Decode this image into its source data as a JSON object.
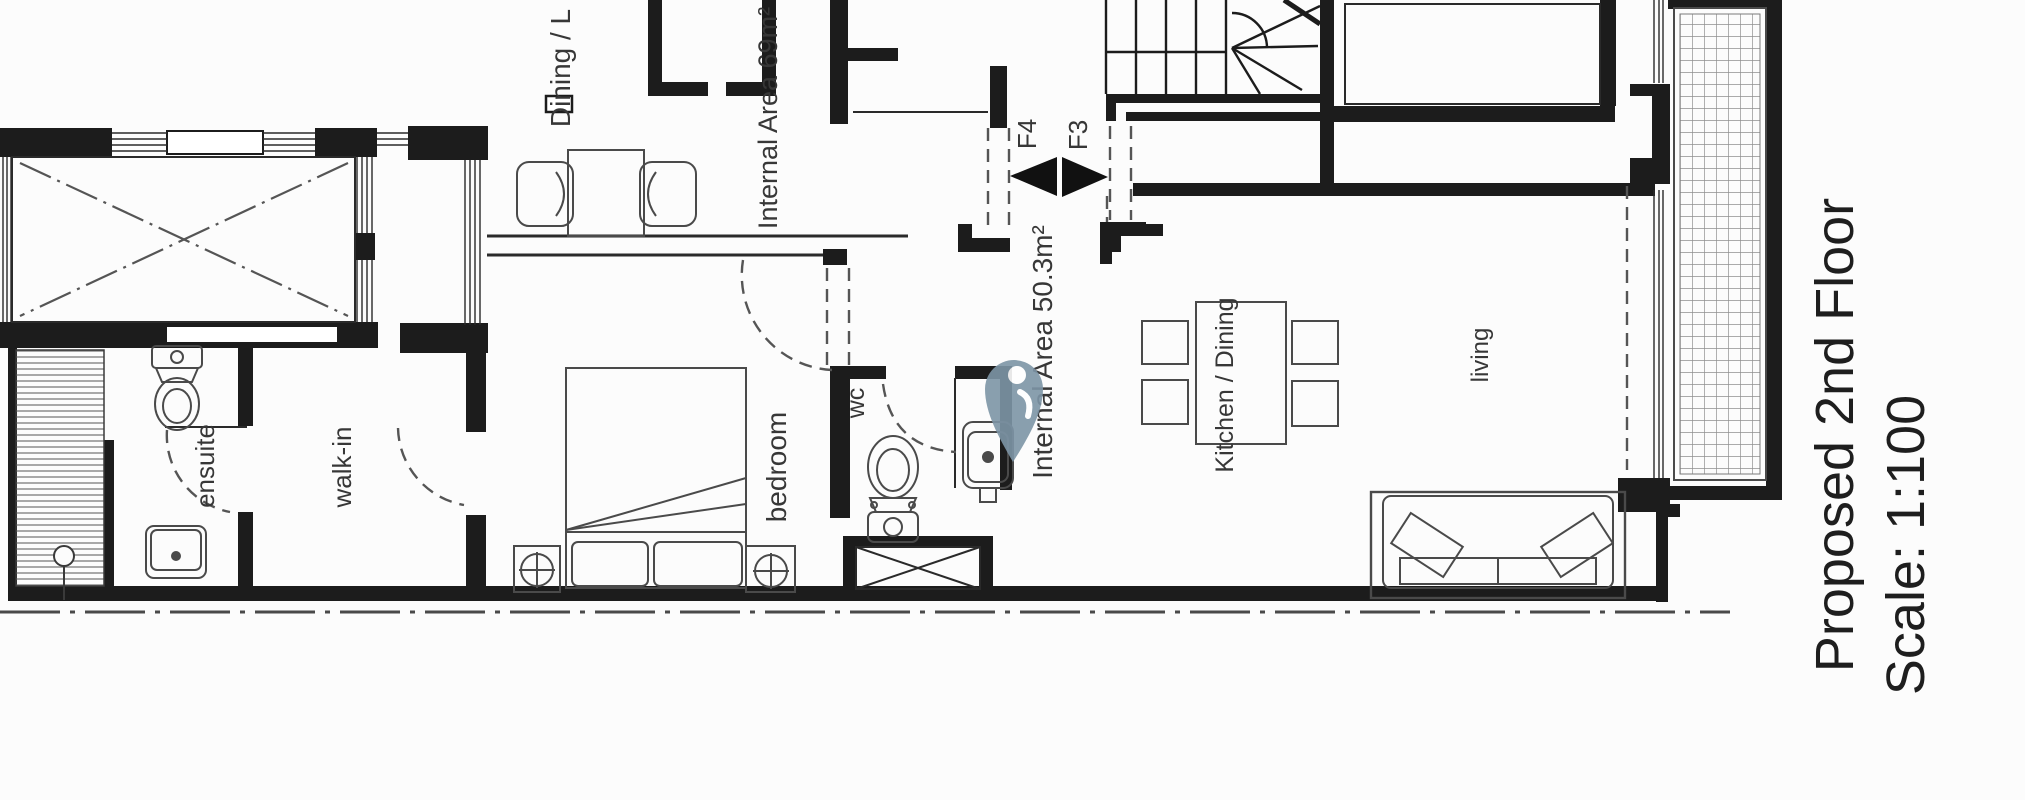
{
  "drawing": {
    "title": "Proposed 2nd Floor",
    "scale": "Scale: 1:100"
  },
  "rooms": {
    "dining_living": "Dining / L",
    "internal_area_upper": "Internal Area 69m²",
    "internal_area_lower": "Internal Area 50.3m²",
    "ensuite": "ensuite",
    "walk_in": "walk-in",
    "bedroom": "bedroom",
    "wc": "wc",
    "kitchen_dining": "Kitchen / Dining",
    "living": "living"
  },
  "markers": {
    "flight_upper": "F4",
    "flight_lower": "F3"
  },
  "icons": {
    "location_pin": "map-location-pin"
  },
  "colors": {
    "pin": "#7d95a6",
    "wall": "#1c1c1c",
    "line": "#3a3a3a",
    "background": "#fcfcfc"
  }
}
